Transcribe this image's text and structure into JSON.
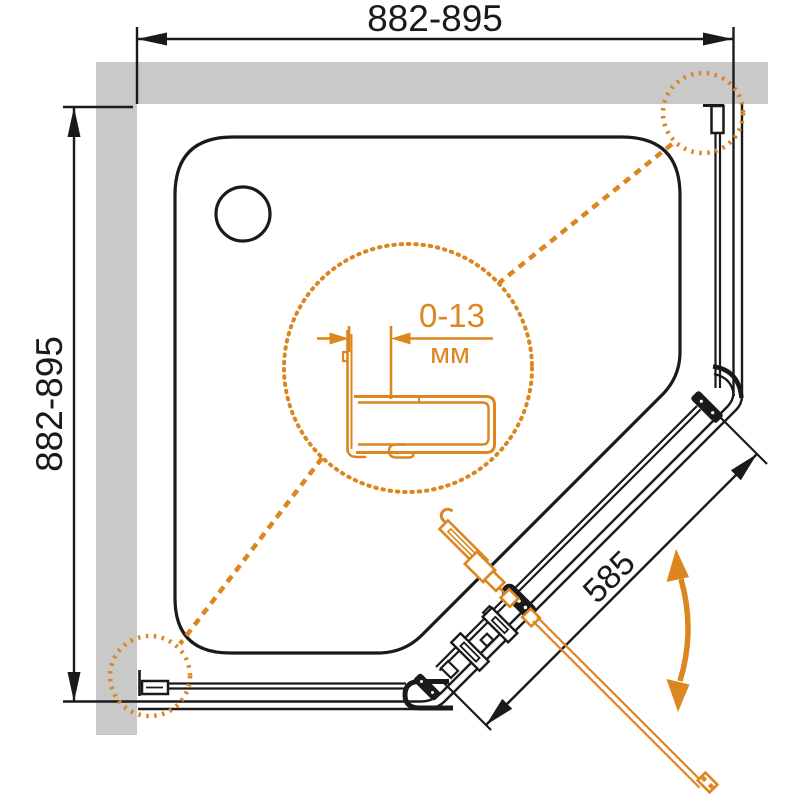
{
  "diagram": {
    "dimensions": {
      "width_range": "882-895",
      "depth_range": "882-895",
      "door_width": "585"
    },
    "detail": {
      "adjustment_range": "0-13",
      "unit": "мм"
    },
    "colors": {
      "accent_orange": "#DC861F",
      "wall_gray": "#C9C9C9",
      "line_black": "#1A1A1A"
    }
  }
}
